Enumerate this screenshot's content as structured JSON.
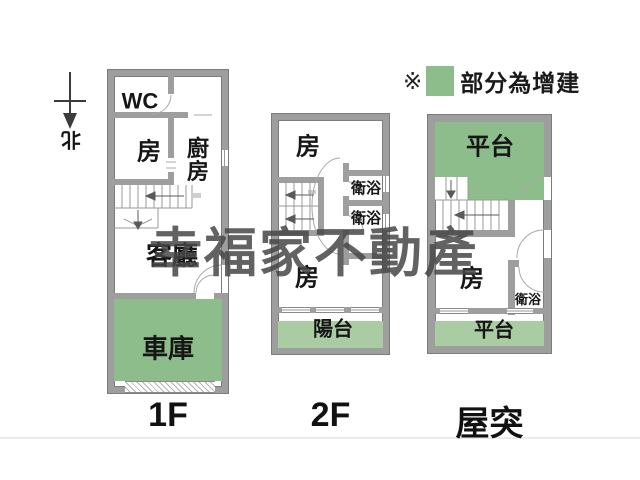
{
  "legend": {
    "marker": "※",
    "label": "部分為增建"
  },
  "compass": {
    "label": "北"
  },
  "watermark": {
    "text": "幸福家不動產"
  },
  "colors": {
    "wall": "#9e9e9e",
    "green": "#8dbd8b",
    "greenlight": "#a9cca2",
    "watermark": "#464646"
  },
  "plans": [
    {
      "floor_label": "1F",
      "rooms": {
        "wc": "WC",
        "bedroom": "房",
        "kitchen": "廚房",
        "living_room": "客廳",
        "garage": "車庫"
      }
    },
    {
      "floor_label": "2F",
      "rooms": {
        "bedroom_top": "房",
        "bath_1": "衛浴",
        "bath_2": "衛浴",
        "bedroom_bottom": "房",
        "balcony": "陽台"
      }
    },
    {
      "floor_label": "屋突",
      "rooms": {
        "deck_top": "平台",
        "bedroom": "房",
        "bath": "衛浴",
        "deck_bottom": "平台"
      }
    }
  ]
}
